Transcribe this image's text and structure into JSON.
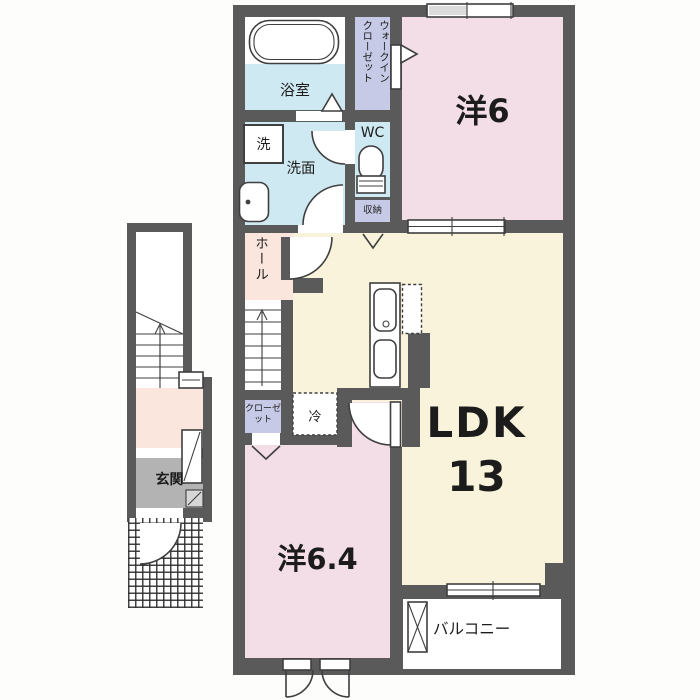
{
  "colors": {
    "wall": "#5a5a5a",
    "waterblue": "#cfe9f2",
    "roompink": "#f3dde7",
    "ldkcream": "#f8f3da",
    "closetlav": "#c6cae6",
    "hallpeach": "#fbe6de",
    "entrygray": "#b3b3b3"
  },
  "rooms": {
    "bathroom": {
      "label": "浴室"
    },
    "walk_in_closet": {
      "label_col1": "ウォークイン",
      "label_col2": "クローゼット"
    },
    "western_room_6": {
      "label": "洋6"
    },
    "washer": {
      "label": "洗"
    },
    "washroom": {
      "label": "洗面"
    },
    "toilet": {
      "label": "WC"
    },
    "storage": {
      "label": "収納"
    },
    "hall": {
      "label": "ホール"
    },
    "closet": {
      "label": "クローゼット"
    },
    "refrigerator": {
      "label": "冷"
    },
    "ldk": {
      "label": "LDK",
      "size": "13"
    },
    "western_room_64": {
      "label": "洋6.4"
    },
    "balcony": {
      "label": "バルコニー"
    },
    "entrance": {
      "label": "玄関"
    }
  }
}
